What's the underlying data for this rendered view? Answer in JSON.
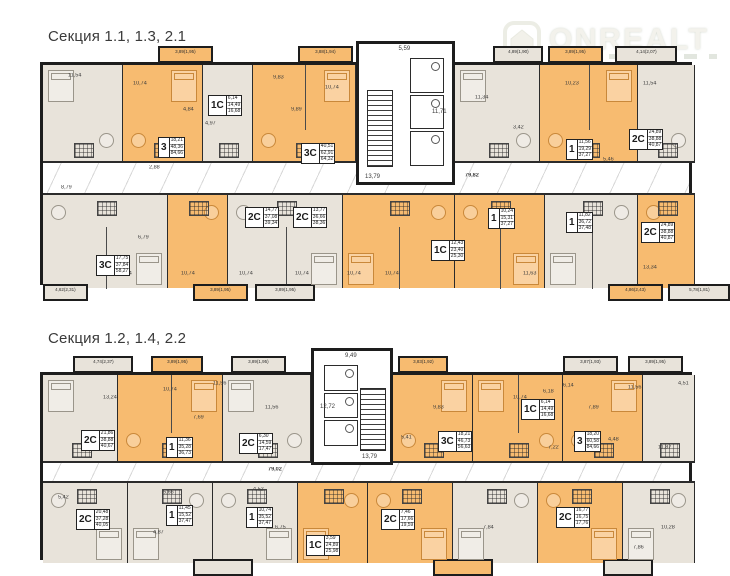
{
  "watermark": {
    "brand": "ONREALT",
    "icon": "house-icon"
  },
  "plans": [
    {
      "title": "Секция 1.1, 1.3, 2.1",
      "title_pos": {
        "x": 48,
        "y": 28
      },
      "frame": {
        "x": 40,
        "y": 62,
        "w": 652,
        "h": 223
      },
      "rows": {
        "top_h": 98,
        "corridor_y": 98,
        "corridor_h": 30,
        "bottom_y": 128,
        "bottom_h": 95
      },
      "core": {
        "x": 313,
        "w": 99,
        "top": -24,
        "h": 144,
        "stairs_side": "left",
        "dims": {
          "top": "5,59",
          "stairs": "13,79",
          "hall": "11,71"
        }
      },
      "corridor_label": {
        "t": "79,82",
        "x": 422,
        "y": 108
      },
      "units": [
        {
          "row": "top",
          "x": 0,
          "w": 80,
          "color": "beige"
        },
        {
          "row": "top",
          "x": 80,
          "w": 80,
          "color": "orange"
        },
        {
          "row": "top",
          "x": 160,
          "w": 50,
          "color": "beige"
        },
        {
          "row": "top",
          "x": 210,
          "w": 103,
          "color": "orange"
        },
        {
          "row": "top",
          "x": 412,
          "w": 85,
          "color": "beige"
        },
        {
          "row": "top",
          "x": 497,
          "w": 98,
          "color": "orange"
        },
        {
          "row": "top",
          "x": 595,
          "w": 57,
          "color": "beige"
        },
        {
          "row": "bottom",
          "x": 0,
          "w": 125,
          "color": "beige"
        },
        {
          "row": "bottom",
          "x": 125,
          "w": 60,
          "color": "orange"
        },
        {
          "row": "bottom",
          "x": 185,
          "w": 115,
          "color": "beige"
        },
        {
          "row": "bottom",
          "x": 300,
          "w": 112,
          "color": "orange"
        },
        {
          "row": "bottom",
          "x": 412,
          "w": 90,
          "color": "orange"
        },
        {
          "row": "bottom",
          "x": 502,
          "w": 93,
          "color": "beige"
        },
        {
          "row": "bottom",
          "x": 595,
          "w": 57,
          "color": "orange"
        }
      ],
      "labels": [
        {
          "t": "3",
          "areas": [
            "18,21",
            "48,36",
            "84,66"
          ],
          "x": 115,
          "y": 72
        },
        {
          "t": "1С",
          "areas": [
            "6,14",
            "14,49",
            "16,68"
          ],
          "x": 165,
          "y": 30
        },
        {
          "t": "3С",
          "areas": [
            "40,51",
            "62,91",
            "64,32"
          ],
          "x": 258,
          "y": 78
        },
        {
          "t": "1",
          "areas": [
            "11,56",
            "19,29",
            "37,27"
          ],
          "x": 523,
          "y": 74
        },
        {
          "t": "2С",
          "areas": [
            "24,89",
            "38,88",
            "40,87"
          ],
          "x": 586,
          "y": 64
        },
        {
          "t": "3С",
          "areas": [
            "17,75",
            "37,84",
            "58,27"
          ],
          "x": 53,
          "y": 190
        },
        {
          "t": "2С",
          "areas": [
            "14,77",
            "37,08",
            "39,34"
          ],
          "x": 202,
          "y": 142
        },
        {
          "t": "2С",
          "areas": [
            "13,77",
            "36,66",
            "38,36"
          ],
          "x": 250,
          "y": 142
        },
        {
          "t": "1С",
          "areas": [
            "12,43",
            "23,40",
            "25,30"
          ],
          "x": 388,
          "y": 175
        },
        {
          "t": "1",
          "areas": [
            "10,24",
            "15,31",
            "37,27"
          ],
          "x": 445,
          "y": 143
        },
        {
          "t": "1",
          "areas": [
            "11,82",
            "36,72",
            "37,48"
          ],
          "x": 523,
          "y": 147
        },
        {
          "t": "2С",
          "areas": [
            "24,89",
            "38,88",
            "40,87"
          ],
          "x": 598,
          "y": 157
        }
      ],
      "dims": [
        {
          "t": "11,54",
          "x": 25,
          "y": 8
        },
        {
          "t": "10,74",
          "x": 90,
          "y": 16
        },
        {
          "t": "4,84",
          "x": 140,
          "y": 42
        },
        {
          "t": "9,83",
          "x": 230,
          "y": 10
        },
        {
          "t": "10,74",
          "x": 282,
          "y": 20
        },
        {
          "t": "9,89",
          "x": 248,
          "y": 42
        },
        {
          "t": "4,97",
          "x": 162,
          "y": 56
        },
        {
          "t": "11,34",
          "x": 432,
          "y": 30
        },
        {
          "t": "3,42",
          "x": 470,
          "y": 60
        },
        {
          "t": "10,23",
          "x": 522,
          "y": 16
        },
        {
          "t": "11,54",
          "x": 600,
          "y": 16
        },
        {
          "t": "6,79",
          "x": 95,
          "y": 170
        },
        {
          "t": "10,74",
          "x": 75,
          "y": 206
        },
        {
          "t": "10,74",
          "x": 138,
          "y": 206
        },
        {
          "t": "10,74",
          "x": 196,
          "y": 206
        },
        {
          "t": "10,74",
          "x": 252,
          "y": 206
        },
        {
          "t": "10,74",
          "x": 304,
          "y": 206
        },
        {
          "t": "10,74",
          "x": 342,
          "y": 206
        },
        {
          "t": "11,63",
          "x": 480,
          "y": 206
        },
        {
          "t": "13,34",
          "x": 600,
          "y": 200
        },
        {
          "t": "2,88",
          "x": 106,
          "y": 100
        },
        {
          "t": "6,48",
          "x": 388,
          "y": 92
        },
        {
          "t": "5,46",
          "x": 560,
          "y": 92
        },
        {
          "t": "8,79",
          "x": 18,
          "y": 120
        }
      ],
      "balconies": [
        {
          "edge": "top",
          "x": 115,
          "w": 55,
          "color": "orange",
          "label": "3,89(1,95)"
        },
        {
          "edge": "top",
          "x": 255,
          "w": 55,
          "color": "orange",
          "label": "3,88(1,94)"
        },
        {
          "edge": "top",
          "x": 450,
          "w": 50,
          "color": "beige",
          "label": "4,89(1,90)"
        },
        {
          "edge": "top",
          "x": 505,
          "w": 55,
          "color": "orange",
          "label": "3,89(1,95)"
        },
        {
          "edge": "top",
          "x": 572,
          "w": 62,
          "color": "beige",
          "label": "4,14(2,07)"
        },
        {
          "edge": "bottom",
          "x": 0,
          "w": 45,
          "color": "beige",
          "label": "4,62(2,31)"
        },
        {
          "edge": "bottom",
          "x": 150,
          "w": 55,
          "color": "orange",
          "label": "3,89(1,95)"
        },
        {
          "edge": "bottom",
          "x": 212,
          "w": 60,
          "color": "beige",
          "label": "3,89(1,95)"
        },
        {
          "edge": "bottom",
          "x": 565,
          "w": 55,
          "color": "orange",
          "label": "4,86(2,43)"
        },
        {
          "edge": "bottom",
          "x": 625,
          "w": 62,
          "color": "beige",
          "label": "5,78(1,81)"
        }
      ]
    },
    {
      "title": "Секция 1.2, 1.4, 2.2",
      "title_pos": {
        "x": 48,
        "y": 330
      },
      "frame": {
        "x": 40,
        "y": 372,
        "w": 652,
        "h": 188
      },
      "rows": {
        "top_h": 88,
        "corridor_y": 88,
        "corridor_h": 18,
        "bottom_y": 106,
        "bottom_h": 82
      },
      "core": {
        "x": 268,
        "w": 82,
        "top": -27,
        "h": 117,
        "stairs_side": "right",
        "dims": {
          "top": "9,49",
          "stairs": "13,79",
          "hall": "12,72"
        }
      },
      "corridor_label": {
        "t": "79,02",
        "x": 225,
        "y": 92
      },
      "units": [
        {
          "row": "top",
          "x": 0,
          "w": 75,
          "color": "beige"
        },
        {
          "row": "top",
          "x": 75,
          "w": 105,
          "color": "orange"
        },
        {
          "row": "top",
          "x": 180,
          "w": 88,
          "color": "beige"
        },
        {
          "row": "top",
          "x": 350,
          "w": 80,
          "color": "orange"
        },
        {
          "row": "top",
          "x": 430,
          "w": 90,
          "color": "orange"
        },
        {
          "row": "top",
          "x": 520,
          "w": 80,
          "color": "orange"
        },
        {
          "row": "top",
          "x": 600,
          "w": 52,
          "color": "beige"
        },
        {
          "row": "bottom",
          "x": 0,
          "w": 85,
          "color": "beige"
        },
        {
          "row": "bottom",
          "x": 85,
          "w": 85,
          "color": "beige"
        },
        {
          "row": "bottom",
          "x": 170,
          "w": 85,
          "color": "beige"
        },
        {
          "row": "bottom",
          "x": 255,
          "w": 70,
          "color": "orange"
        },
        {
          "row": "bottom",
          "x": 325,
          "w": 85,
          "color": "orange"
        },
        {
          "row": "bottom",
          "x": 410,
          "w": 85,
          "color": "beige"
        },
        {
          "row": "bottom",
          "x": 495,
          "w": 85,
          "color": "orange"
        },
        {
          "row": "bottom",
          "x": 580,
          "w": 72,
          "color": "beige"
        }
      ],
      "labels": [
        {
          "t": "2С",
          "areas": [
            "21,86",
            "38,88",
            "40,67"
          ],
          "x": 38,
          "y": 55
        },
        {
          "t": "1",
          "areas": [
            "11,36",
            "35,28",
            "36,73"
          ],
          "x": 123,
          "y": 62
        },
        {
          "t": "2С",
          "areas": [
            "6,30",
            "14,59",
            "17,47"
          ],
          "x": 196,
          "y": 58
        },
        {
          "t": "3С",
          "areas": [
            "18,21",
            "46,73",
            "56,63"
          ],
          "x": 395,
          "y": 56
        },
        {
          "t": "1С",
          "areas": [
            "6,14",
            "14,49",
            "16,68"
          ],
          "x": 478,
          "y": 24
        },
        {
          "t": "3",
          "areas": [
            "18,20",
            "60,58",
            "84,66"
          ],
          "x": 531,
          "y": 56
        },
        {
          "t": "2С",
          "areas": [
            "20,48",
            "37,28",
            "40,05"
          ],
          "x": 33,
          "y": 134
        },
        {
          "t": "1",
          "areas": [
            "11,45",
            "15,52",
            "37,47"
          ],
          "x": 123,
          "y": 130
        },
        {
          "t": "1",
          "areas": [
            "10,74",
            "35,52",
            "37,47"
          ],
          "x": 203,
          "y": 132
        },
        {
          "t": "1С",
          "areas": [
            "3,59",
            "24,89",
            "25,98"
          ],
          "x": 263,
          "y": 160
        },
        {
          "t": "2С",
          "areas": [
            "7,46",
            "17,66",
            "19,59"
          ],
          "x": 338,
          "y": 134
        },
        {
          "t": "2С",
          "areas": [
            "16,77",
            "16,75",
            "17,76"
          ],
          "x": 513,
          "y": 132
        }
      ],
      "dims": [
        {
          "t": "13,24",
          "x": 60,
          "y": 20
        },
        {
          "t": "10,74",
          "x": 120,
          "y": 12
        },
        {
          "t": "11,56",
          "x": 170,
          "y": 6
        },
        {
          "t": "7,69",
          "x": 150,
          "y": 40
        },
        {
          "t": "11,56",
          "x": 222,
          "y": 30
        },
        {
          "t": "6,18",
          "x": 500,
          "y": 14
        },
        {
          "t": "10,74",
          "x": 470,
          "y": 20
        },
        {
          "t": "7,89",
          "x": 545,
          "y": 30
        },
        {
          "t": "11,56",
          "x": 585,
          "y": 10
        },
        {
          "t": "6,14",
          "x": 520,
          "y": 8
        },
        {
          "t": "4,51",
          "x": 635,
          "y": 6
        },
        {
          "t": "11,87",
          "x": 615,
          "y": 70
        },
        {
          "t": "4,48",
          "x": 565,
          "y": 62
        },
        {
          "t": "7,22",
          "x": 505,
          "y": 70
        },
        {
          "t": "5,42",
          "x": 15,
          "y": 120
        },
        {
          "t": "5,66",
          "x": 120,
          "y": 115
        },
        {
          "t": "4,52",
          "x": 210,
          "y": 112
        },
        {
          "t": "6,75",
          "x": 232,
          "y": 150
        },
        {
          "t": "5,41",
          "x": 358,
          "y": 60
        },
        {
          "t": "9,83",
          "x": 390,
          "y": 30
        },
        {
          "t": "7,84",
          "x": 440,
          "y": 150
        },
        {
          "t": "10,28",
          "x": 618,
          "y": 150
        },
        {
          "t": "7,86",
          "x": 590,
          "y": 170
        },
        {
          "t": "4,87",
          "x": 110,
          "y": 155
        }
      ],
      "balconies": [
        {
          "edge": "top",
          "x": 30,
          "w": 60,
          "color": "beige",
          "label": "4,74(2,37)"
        },
        {
          "edge": "top",
          "x": 108,
          "w": 52,
          "color": "orange",
          "label": "3,89(1,95)"
        },
        {
          "edge": "top",
          "x": 188,
          "w": 55,
          "color": "beige",
          "label": "3,89(1,95)"
        },
        {
          "edge": "top",
          "x": 355,
          "w": 50,
          "color": "orange",
          "label": "3,83(1,92)"
        },
        {
          "edge": "top",
          "x": 520,
          "w": 55,
          "color": "beige",
          "label": "3,87(1,93)"
        },
        {
          "edge": "top",
          "x": 585,
          "w": 55,
          "color": "beige",
          "label": "3,89(1,95)"
        },
        {
          "edge": "bottom",
          "x": 150,
          "w": 60,
          "color": "beige",
          "label": ""
        },
        {
          "edge": "bottom",
          "x": 390,
          "w": 60,
          "color": "orange",
          "label": ""
        },
        {
          "edge": "bottom",
          "x": 560,
          "w": 50,
          "color": "beige",
          "label": ""
        }
      ]
    }
  ],
  "colors": {
    "orange": "#f7bb70",
    "beige": "#e8e3da",
    "wall": "#1d1d1d"
  }
}
